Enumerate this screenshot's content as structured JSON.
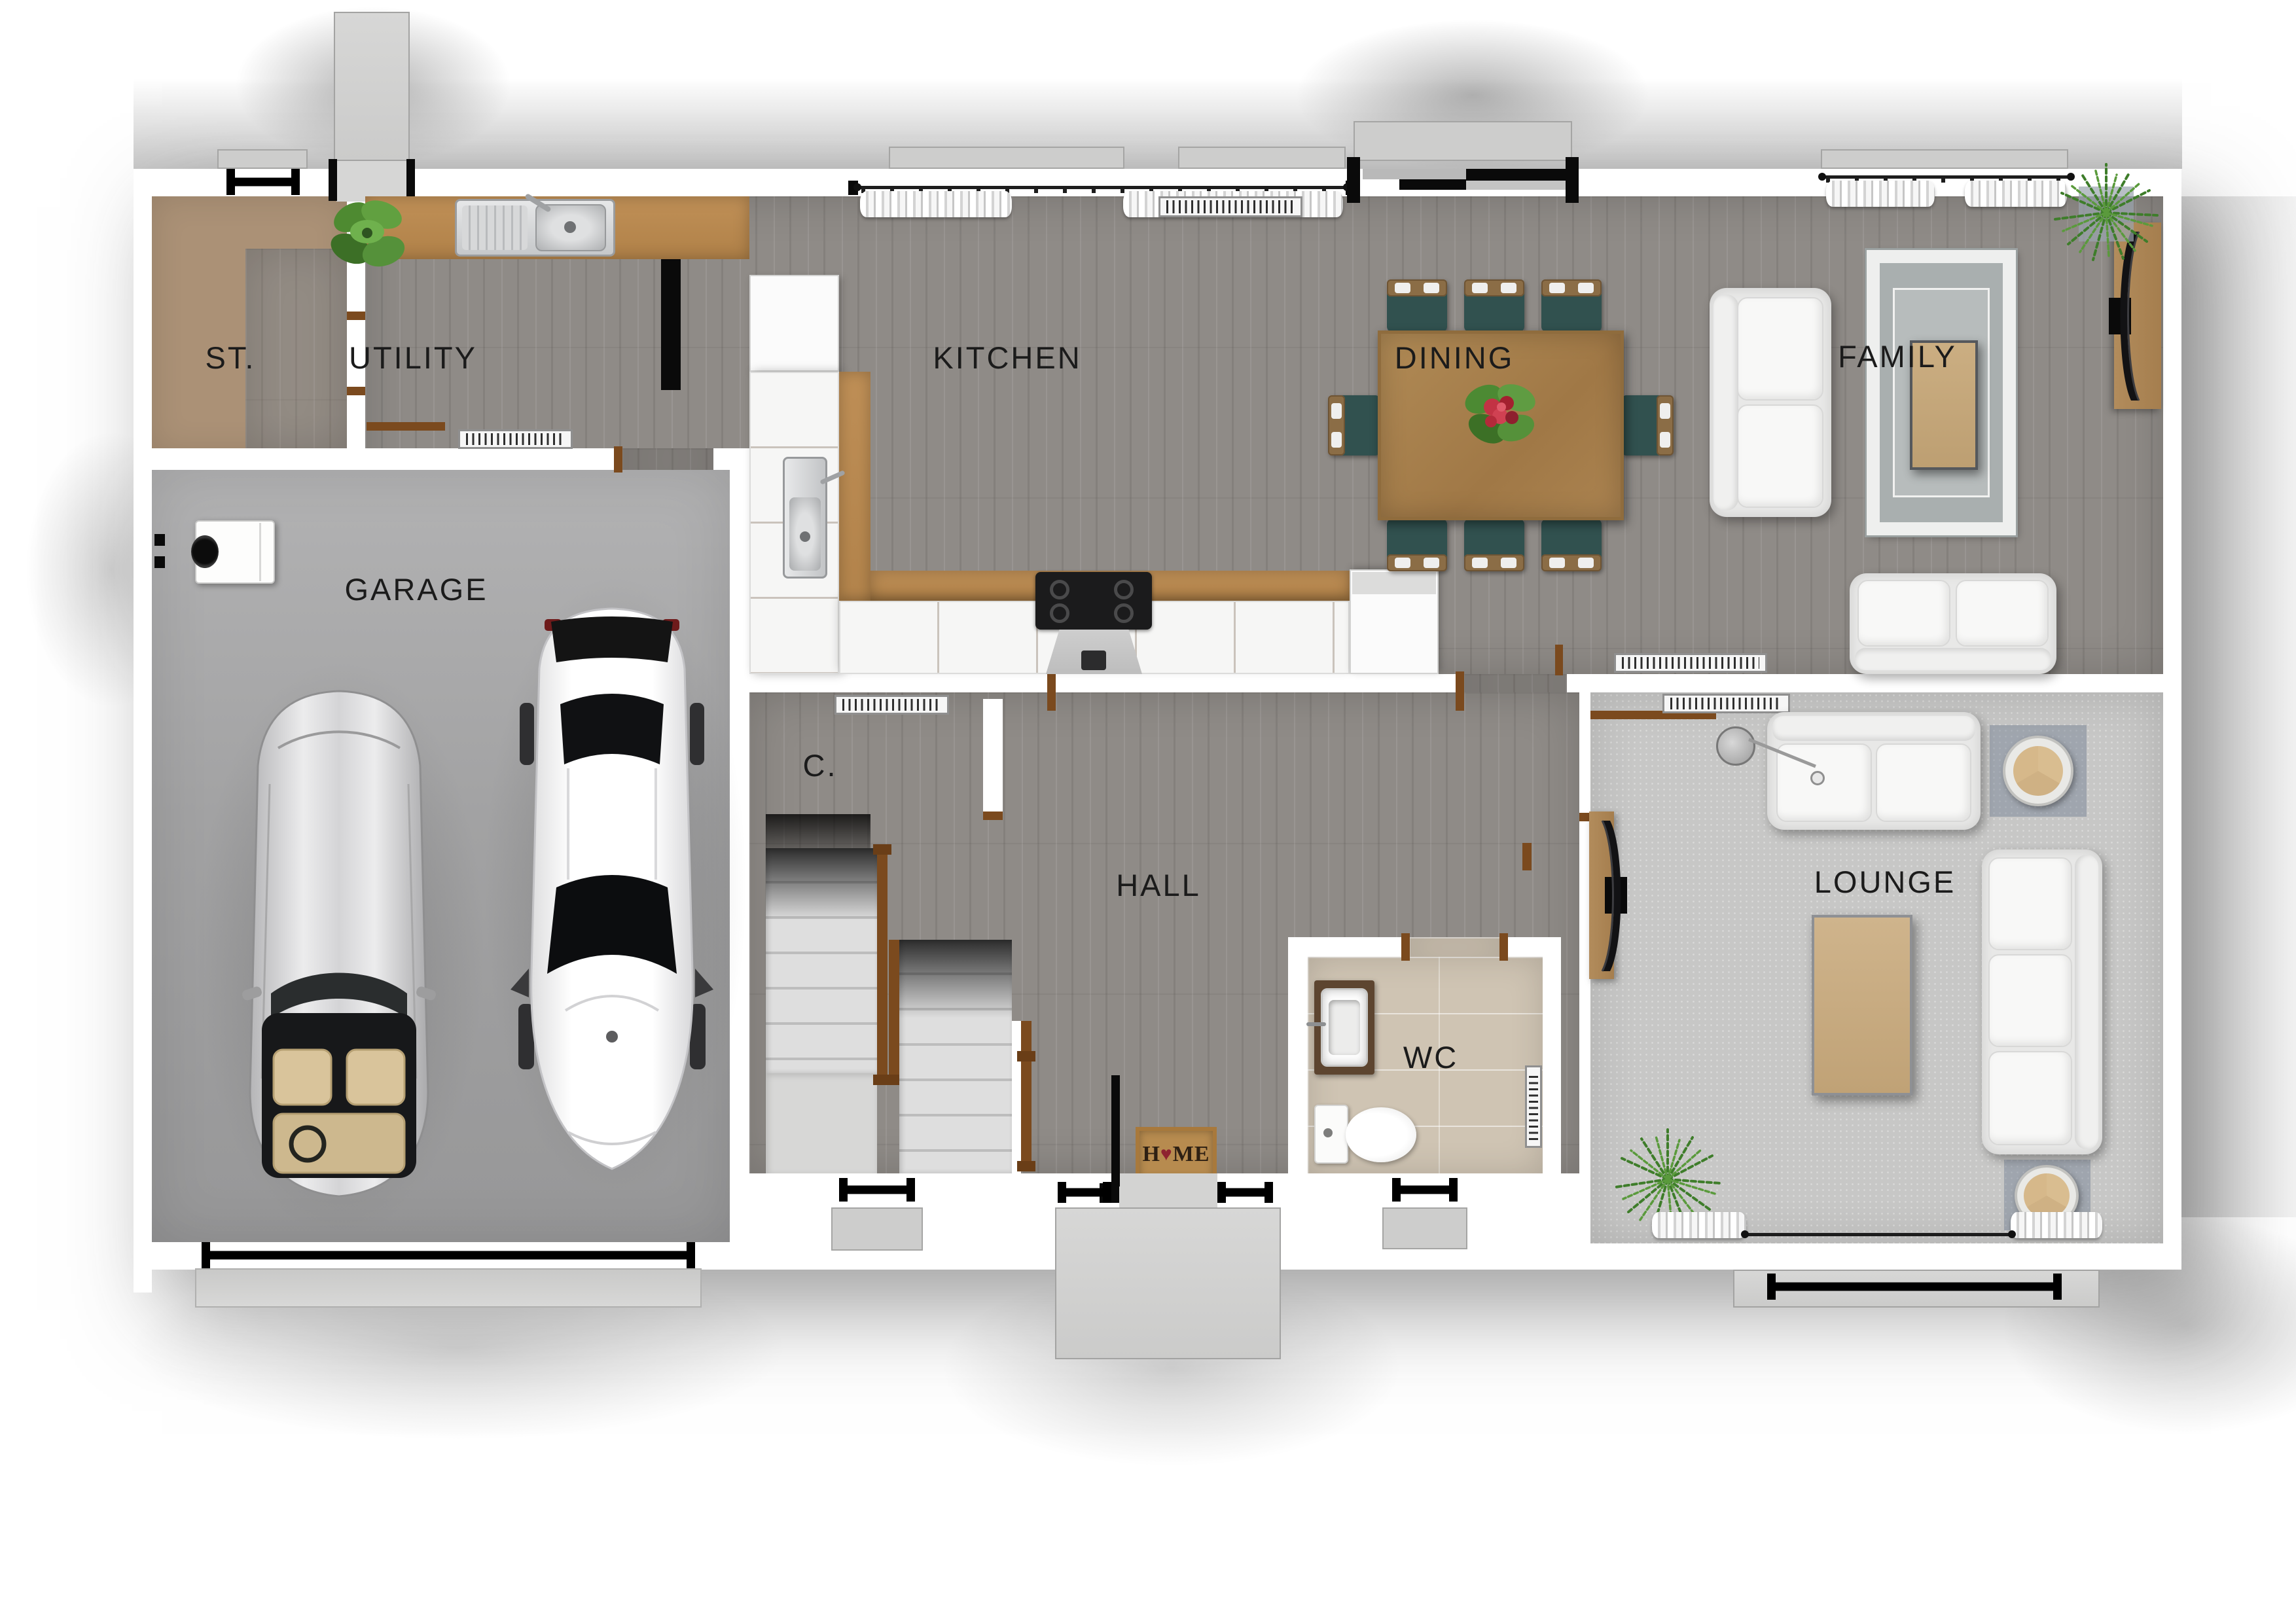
{
  "rooms": [
    {
      "id": "st",
      "label": "ST."
    },
    {
      "id": "utility",
      "label": "UTILITY"
    },
    {
      "id": "kitchen",
      "label": "KITCHEN"
    },
    {
      "id": "dining",
      "label": "DINING"
    },
    {
      "id": "family",
      "label": "FAMILY"
    },
    {
      "id": "garage",
      "label": "GARAGE"
    },
    {
      "id": "cupboard",
      "label": "C."
    },
    {
      "id": "hall",
      "label": "HALL"
    },
    {
      "id": "wc",
      "label": "WC"
    },
    {
      "id": "lounge",
      "label": "LOUNGE"
    }
  ],
  "doormat": {
    "prefix": "H",
    "heart": "♥",
    "suffix": "ME"
  },
  "colors": {
    "wood_floor": "#8f8b87",
    "carpet": "#c7c7c6",
    "wc_tile": "#cfc4b3",
    "store_tan": "#ab9176",
    "garage_floor": "#a6a6a6",
    "wall": "#ffffff",
    "door_jamb": "#7b4a1e",
    "counter_wood": "#b98a55",
    "dining_table_wood": "#a5804d",
    "chair_cushion_teal": "#31514f",
    "sofa_white": "#f4f4f3",
    "doormat_tan": "#b78b4f",
    "doormat_heart": "#8e2330",
    "window_symbol": "#000000"
  }
}
